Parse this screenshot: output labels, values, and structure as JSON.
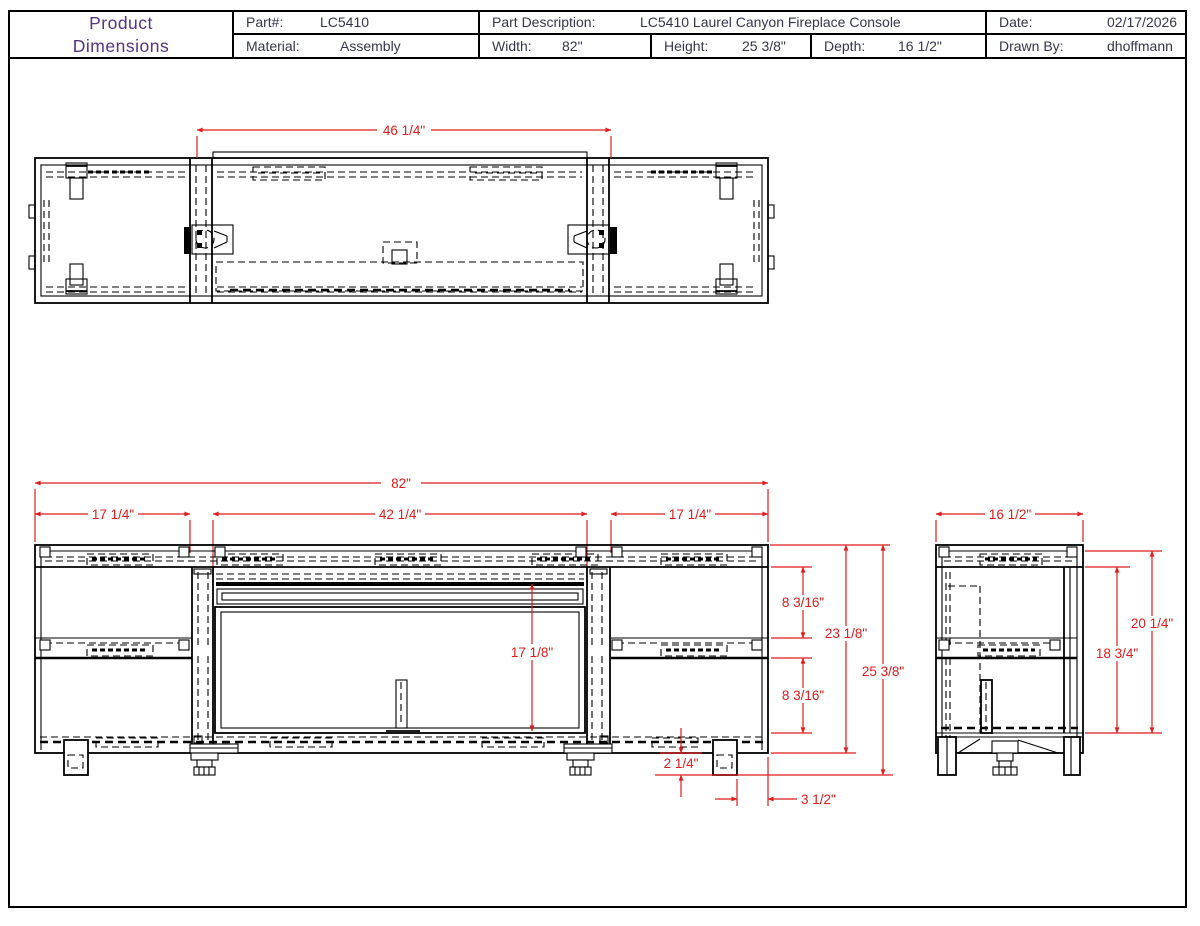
{
  "title_block": {
    "title_line1": "Product",
    "title_line2": "Dimensions",
    "part_label": "Part#:",
    "part_value": "LC5410",
    "material_label": "Material:",
    "material_value": "Assembly",
    "part_description_label": "Part Description:",
    "part_description_value": "LC5410 Laurel Canyon Fireplace Console",
    "width_label": "Width:",
    "width_value": "82\"",
    "height_label": "Height:",
    "height_value": "25 3/8\"",
    "depth_label": "Depth:",
    "depth_value": "16 1/2\"",
    "date_label": "Date:",
    "date_value": "02/17/2026",
    "drawn_by_label": "Drawn By:",
    "drawn_by_value": "dhoffmann"
  },
  "colors": {
    "dimension_red": "#e11b1b",
    "line_black": "#000000",
    "title_purple": "#553285",
    "field_text": "#33364a"
  },
  "dims": {
    "top_view_center_width": "46 1/4\"",
    "front_overall_width": "82\"",
    "front_left_width": "17 1/4\"",
    "front_center_width": "42 1/4\"",
    "front_right_width": "17 1/4\"",
    "front_opening_height": "17 1/8\"",
    "front_upper_compartment": "8 3/16\"",
    "front_lower_compartment": "8 3/16\"",
    "front_case_height": "23 1/8\"",
    "front_overall_height": "25 3/8\"",
    "front_leg_height": "2 1/4\"",
    "front_leg_inset": "3 1/2\"",
    "side_depth": "16 1/2\"",
    "side_case_height": "18 3/4\"",
    "side_overall_height": "20 1/4\""
  }
}
